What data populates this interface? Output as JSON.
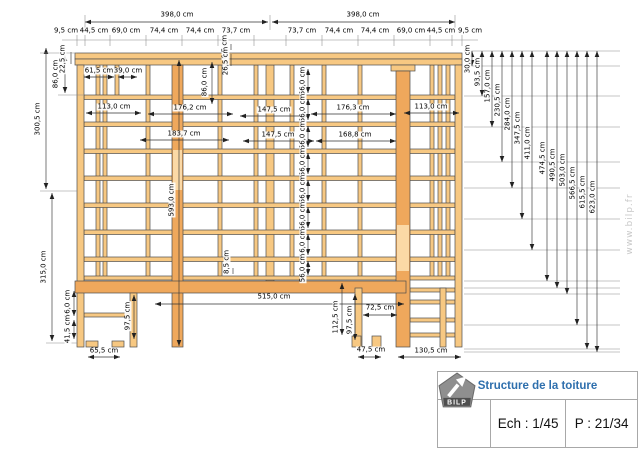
{
  "title_block": {
    "title": "Structure de la toiture",
    "scale_label": "Ech : 1/45",
    "page_label": "P : 21/34",
    "logo_text": "BILP"
  },
  "watermark": "www.bilp.fr",
  "diagram": {
    "unit": "cm",
    "labels": [
      {
        "t": "398,0 cm",
        "x": 177,
        "y": 15,
        "r": 0
      },
      {
        "t": "398,0 cm",
        "x": 363,
        "y": 15,
        "r": 0
      },
      {
        "t": "9,5 cm",
        "x": 66,
        "y": 31,
        "r": 0
      },
      {
        "t": "44,5 cm",
        "x": 94,
        "y": 31,
        "r": 0
      },
      {
        "t": "69,0 cm",
        "x": 126,
        "y": 31,
        "r": 0
      },
      {
        "t": "74,4 cm",
        "x": 164,
        "y": 31,
        "r": 0
      },
      {
        "t": "74,4 cm",
        "x": 200,
        "y": 31,
        "r": 0
      },
      {
        "t": "73,7 cm",
        "x": 236,
        "y": 31,
        "r": 0
      },
      {
        "t": "73,7 cm",
        "x": 302,
        "y": 31,
        "r": 0
      },
      {
        "t": "74,4 cm",
        "x": 339,
        "y": 31,
        "r": 0
      },
      {
        "t": "74,4 cm",
        "x": 375,
        "y": 31,
        "r": 0
      },
      {
        "t": "69,0 cm",
        "x": 411,
        "y": 31,
        "r": 0
      },
      {
        "t": "44,5 cm",
        "x": 441,
        "y": 31,
        "r": 0
      },
      {
        "t": "9,5 cm",
        "x": 470,
        "y": 31,
        "r": 0
      },
      {
        "t": "22,5 cm",
        "x": 63,
        "y": 59,
        "r": 1
      },
      {
        "t": "86,0 cm",
        "x": 56,
        "y": 74,
        "r": 1
      },
      {
        "t": "300,5 cm",
        "x": 38,
        "y": 119,
        "r": 1
      },
      {
        "t": "315,0 cm",
        "x": 44,
        "y": 267,
        "r": 1
      },
      {
        "t": "61,5 cm",
        "x": 99,
        "y": 71,
        "r": 0
      },
      {
        "t": "39,0 cm",
        "x": 128,
        "y": 71,
        "r": 0
      },
      {
        "t": "113,0 cm",
        "x": 114,
        "y": 107,
        "r": 0
      },
      {
        "t": "86,0 cm",
        "x": 205,
        "y": 82,
        "r": 1
      },
      {
        "t": "6,5 cm",
        "x": 225,
        "y": 47,
        "r": 1
      },
      {
        "t": "26,5 cm",
        "x": 226,
        "y": 61,
        "r": 1
      },
      {
        "t": "176,2 cm",
        "x": 190,
        "y": 108,
        "r": 0
      },
      {
        "t": "147,5 cm",
        "x": 274,
        "y": 110,
        "r": 0
      },
      {
        "t": "176,3 cm",
        "x": 353,
        "y": 108,
        "r": 0
      },
      {
        "t": "113,0 cm",
        "x": 431,
        "y": 107,
        "r": 0
      },
      {
        "t": "183,7 cm",
        "x": 184,
        "y": 134,
        "r": 0
      },
      {
        "t": "147,5 cm",
        "x": 278,
        "y": 135,
        "r": 0
      },
      {
        "t": "168,8 cm",
        "x": 355,
        "y": 135,
        "r": 0
      },
      {
        "t": "56,0 cm",
        "x": 303,
        "y": 81,
        "r": 1
      },
      {
        "t": "56,0 cm",
        "x": 303,
        "y": 108,
        "r": 1
      },
      {
        "t": "56,0 cm",
        "x": 303,
        "y": 135,
        "r": 1
      },
      {
        "t": "56,0 cm",
        "x": 303,
        "y": 162,
        "r": 1
      },
      {
        "t": "56,0 cm",
        "x": 303,
        "y": 189,
        "r": 1
      },
      {
        "t": "56,0 cm",
        "x": 303,
        "y": 216,
        "r": 1
      },
      {
        "t": "56,0 cm",
        "x": 303,
        "y": 243,
        "r": 1
      },
      {
        "t": "56,0 cm",
        "x": 303,
        "y": 268,
        "r": 1
      },
      {
        "t": "593,0 cm",
        "x": 172,
        "y": 200,
        "r": 1
      },
      {
        "t": "8,5 cm",
        "x": 227,
        "y": 262,
        "r": 1
      },
      {
        "t": "515,0 cm",
        "x": 274,
        "y": 297,
        "r": 0
      },
      {
        "t": "112,5 cm",
        "x": 336,
        "y": 317,
        "r": 1
      },
      {
        "t": "97,5 cm",
        "x": 350,
        "y": 320,
        "r": 1
      },
      {
        "t": "72,5 cm",
        "x": 380,
        "y": 308,
        "r": 0
      },
      {
        "t": "97,5 cm",
        "x": 128,
        "y": 316,
        "r": 1
      },
      {
        "t": "56,0 cm",
        "x": 68,
        "y": 304,
        "r": 1
      },
      {
        "t": "41,5 cm",
        "x": 68,
        "y": 329,
        "r": 1
      },
      {
        "t": "65,5 cm",
        "x": 104,
        "y": 351,
        "r": 0
      },
      {
        "t": "47,5 cm",
        "x": 371,
        "y": 350,
        "r": 0
      },
      {
        "t": "130,5 cm",
        "x": 431,
        "y": 351,
        "r": 0
      },
      {
        "t": "30,0 cm",
        "x": 468,
        "y": 59,
        "r": 1
      },
      {
        "t": "93,5 cm",
        "x": 478,
        "y": 72,
        "r": 1
      },
      {
        "t": "157,0 cm",
        "x": 488,
        "y": 86,
        "r": 1
      },
      {
        "t": "230,5 cm",
        "x": 498,
        "y": 100,
        "r": 1
      },
      {
        "t": "284,0 cm",
        "x": 508,
        "y": 114,
        "r": 1
      },
      {
        "t": "347,5 cm",
        "x": 518,
        "y": 128,
        "r": 1
      },
      {
        "t": "411,0 cm",
        "x": 528,
        "y": 143,
        "r": 1
      },
      {
        "t": "474,5 cm",
        "x": 543,
        "y": 158,
        "r": 1
      },
      {
        "t": "490,5 cm",
        "x": 553,
        "y": 165,
        "r": 1
      },
      {
        "t": "503,0 cm",
        "x": 563,
        "y": 170,
        "r": 1
      },
      {
        "t": "566,5 cm",
        "x": 573,
        "y": 183,
        "r": 1
      },
      {
        "t": "615,5 cm",
        "x": 583,
        "y": 192,
        "r": 1
      },
      {
        "t": "623,0 cm",
        "x": 593,
        "y": 197,
        "r": 1
      }
    ]
  }
}
